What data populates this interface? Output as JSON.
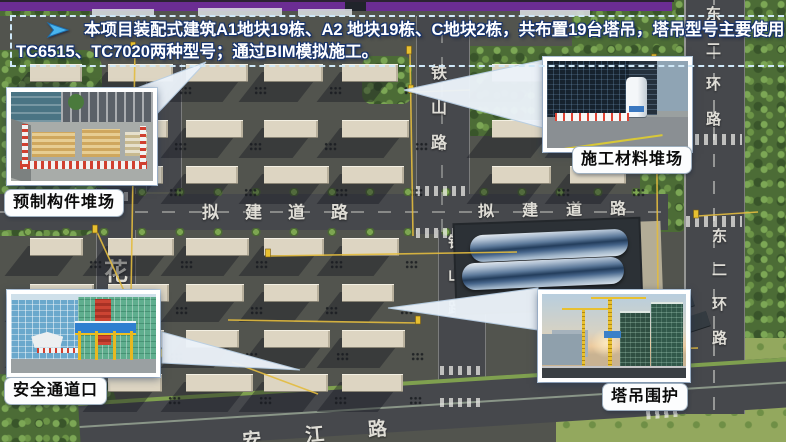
{
  "banner": {
    "line1": "本项目装配式建筑A1地块19栋、A2 地块19栋、C地块2栋，共布置19台塔吊，塔吊型号主要使用",
    "line2": "TC6515、TC7020两种型号；通过BIM模拟施工。"
  },
  "roads": {
    "tieshan": "铁山路",
    "proposed": "拟建道路",
    "east_ring": "东二环路",
    "river": "安江路",
    "flower": "花"
  },
  "callouts": {
    "precast": {
      "label": "预制构件堆场"
    },
    "materials": {
      "label": "施工材料堆场"
    },
    "safety": {
      "label": "安全通道口"
    },
    "crane": {
      "label": "塔吊围护"
    }
  },
  "colors": {
    "accent_bar": "#6b2d93",
    "banner_border": "#cfe8f8",
    "crane_line": "#e3bc3f",
    "label_text": "#0b0b0b"
  }
}
